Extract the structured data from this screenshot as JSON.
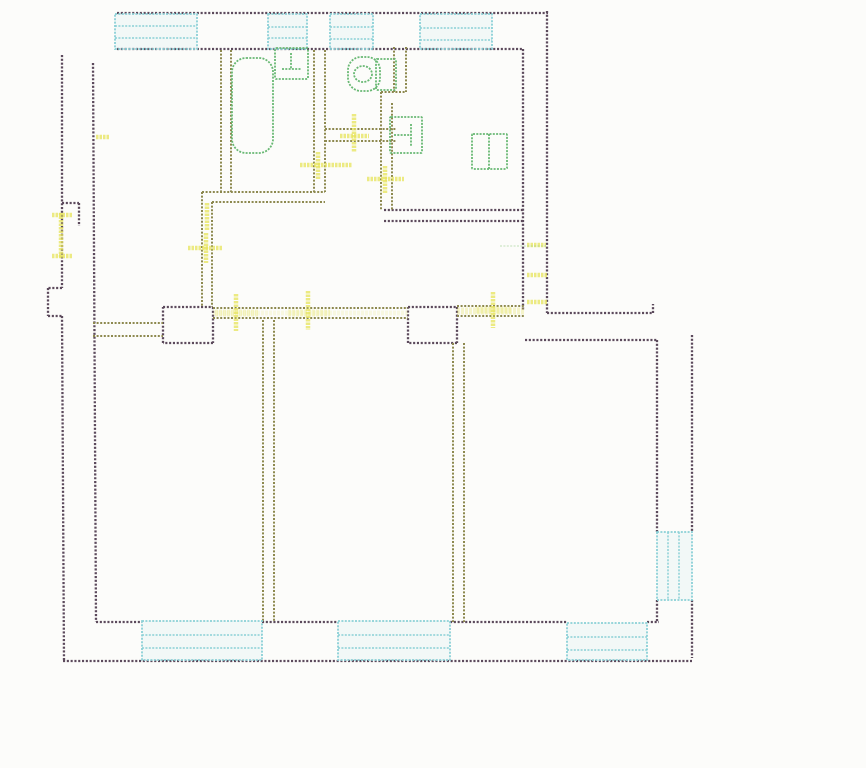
{
  "floor_plan": {
    "canvas": {
      "width": 866,
      "height": 768,
      "background": "#fcfcfa"
    },
    "colors": {
      "outer_wall": "#5c4a5c",
      "interior_wall": "#8d894f",
      "door_mark": "#e7e45b",
      "window_frame": "#8ad0d6",
      "window_fill": "rgba(185,227,232,0.14)",
      "fixture": "#68b873",
      "faint_green": "#9ccf8f"
    },
    "wall_layers": [
      {
        "name": "outer-wall",
        "color": "#5c4a5c",
        "width": 2.3,
        "dash": "2.1 1.7",
        "opacity": 1,
        "segments": [
          [
            117,
            13,
            548,
            13
          ],
          [
            117,
            49,
            523,
            49
          ],
          [
            523,
            49,
            523,
            310
          ],
          [
            547,
            11,
            547,
            313
          ],
          [
            547,
            313,
            653,
            313
          ],
          [
            653,
            313,
            653,
            304
          ],
          [
            525,
            340,
            657,
            340
          ],
          [
            657,
            340,
            657,
            532
          ],
          [
            657,
            600,
            657,
            622
          ],
          [
            692,
            335,
            692,
            532
          ],
          [
            692,
            600,
            692,
            658
          ],
          [
            63,
            661,
            692,
            661
          ],
          [
            96,
            622,
            142,
            622
          ],
          [
            262,
            622,
            338,
            622
          ],
          [
            450,
            622,
            567,
            622
          ],
          [
            647,
            622,
            659,
            622
          ],
          [
            62,
            55,
            62,
            288
          ],
          [
            62,
            288,
            48,
            288
          ],
          [
            48,
            288,
            48,
            316
          ],
          [
            48,
            316,
            62,
            316
          ],
          [
            62,
            316,
            64,
            661
          ],
          [
            93,
            63,
            96,
            622
          ],
          [
            62,
            203,
            79,
            203
          ],
          [
            79,
            203,
            79,
            226
          ],
          [
            163,
            307,
            213,
            307
          ],
          [
            213,
            307,
            213,
            343
          ],
          [
            213,
            343,
            163,
            343
          ],
          [
            163,
            343,
            163,
            307
          ],
          [
            408,
            307,
            457,
            307
          ],
          [
            457,
            307,
            457,
            343
          ],
          [
            457,
            343,
            408,
            343
          ],
          [
            408,
            343,
            408,
            307
          ],
          [
            384,
            210,
            523,
            210
          ],
          [
            384,
            221,
            523,
            221
          ]
        ]
      },
      {
        "name": "interior-wall",
        "color": "#8d894f",
        "width": 2.0,
        "dash": "2 1.6",
        "opacity": 1,
        "segments": [
          [
            221,
            50,
            221,
            192
          ],
          [
            231,
            50,
            231,
            192
          ],
          [
            202,
            192,
            325,
            192
          ],
          [
            212,
            202,
            325,
            202
          ],
          [
            202,
            192,
            202,
            307
          ],
          [
            212,
            202,
            212,
            307
          ],
          [
            314,
            50,
            314,
            192
          ],
          [
            325,
            50,
            325,
            192
          ],
          [
            325,
            129,
            397,
            129
          ],
          [
            325,
            141,
            397,
            141
          ],
          [
            394,
            47,
            394,
            92
          ],
          [
            406,
            47,
            406,
            92
          ],
          [
            381,
            92,
            406,
            92
          ],
          [
            381,
            92,
            381,
            210
          ],
          [
            392,
            103,
            392,
            210
          ],
          [
            93,
            323,
            163,
            323
          ],
          [
            93,
            336,
            163,
            336
          ],
          [
            213,
            308,
            408,
            308
          ],
          [
            213,
            318,
            408,
            318
          ],
          [
            457,
            306,
            524,
            306
          ],
          [
            457,
            316,
            524,
            316
          ],
          [
            263,
            320,
            263,
            622
          ],
          [
            274,
            320,
            274,
            622
          ],
          [
            453,
            343,
            453,
            622
          ],
          [
            464,
            343,
            464,
            622
          ]
        ]
      },
      {
        "name": "corridor-tint",
        "color": "#e7e45b",
        "width": 5,
        "dash": "3 1",
        "opacity": 0.15,
        "segments": [
          [
            213,
            313,
            408,
            313
          ]
        ]
      },
      {
        "name": "door-band",
        "color": "#e7e45b",
        "width": 7,
        "dash": "3 1",
        "opacity": 0.3,
        "segments": [
          [
            215,
            313,
            258,
            313
          ],
          [
            288,
            313,
            330,
            313
          ],
          [
            476,
            310,
            512,
            310
          ],
          [
            457,
            311,
            524,
            311
          ]
        ]
      },
      {
        "name": "door-mark",
        "color": "#e7e45b",
        "width": 4.5,
        "dash": "2.5 1",
        "opacity": 0.75,
        "segments": [
          [
            61,
            213,
            61,
            258
          ],
          [
            52,
            215,
            72,
            215
          ],
          [
            52,
            256,
            72,
            256
          ],
          [
            206,
            233,
            206,
            263
          ],
          [
            188,
            248,
            222,
            248
          ],
          [
            300,
            165,
            352,
            165
          ],
          [
            318,
            152,
            318,
            179
          ],
          [
            354,
            114,
            354,
            152
          ],
          [
            340,
            136,
            369,
            136
          ],
          [
            367,
            179,
            404,
            179
          ],
          [
            385,
            166,
            385,
            193
          ],
          [
            236,
            294,
            236,
            331
          ],
          [
            308,
            291,
            308,
            330
          ],
          [
            493,
            292,
            493,
            328
          ],
          [
            207,
            203,
            207,
            230
          ],
          [
            96,
            137,
            110,
            137
          ],
          [
            527,
            245,
            546,
            245
          ],
          [
            527,
            275,
            547,
            275
          ],
          [
            527,
            302,
            547,
            302
          ]
        ]
      },
      {
        "name": "faint-green-line",
        "color": "#9ccf8f",
        "width": 1.3,
        "dash": "2 1.4",
        "opacity": 0.5,
        "segments": [
          [
            500,
            246,
            546,
            246
          ]
        ]
      }
    ],
    "windows": [
      {
        "name": "window-top-1",
        "x": 115,
        "y": 14,
        "w": 82,
        "h": 35,
        "bars": [
          [
            115,
            26,
            197,
            26
          ],
          [
            115,
            38,
            197,
            38
          ]
        ]
      },
      {
        "name": "window-top-2",
        "x": 268,
        "y": 14,
        "w": 39,
        "h": 35,
        "bars": [
          [
            268,
            27,
            307,
            27
          ],
          [
            268,
            38,
            307,
            38
          ]
        ]
      },
      {
        "name": "window-top-3",
        "x": 330,
        "y": 14,
        "w": 43,
        "h": 35,
        "bars": [
          [
            330,
            27,
            373,
            27
          ],
          [
            330,
            39,
            373,
            39
          ]
        ]
      },
      {
        "name": "window-top-4",
        "x": 420,
        "y": 14,
        "w": 72,
        "h": 35,
        "bars": [
          [
            420,
            28,
            492,
            28
          ],
          [
            420,
            40,
            492,
            40
          ]
        ]
      },
      {
        "name": "window-bottom-1",
        "x": 142,
        "y": 621,
        "w": 120,
        "h": 39,
        "bars": [
          [
            142,
            635,
            262,
            635
          ],
          [
            142,
            648,
            262,
            648
          ]
        ]
      },
      {
        "name": "window-bottom-2",
        "x": 338,
        "y": 621,
        "w": 112,
        "h": 39,
        "bars": [
          [
            338,
            635,
            450,
            635
          ],
          [
            338,
            648,
            450,
            648
          ]
        ]
      },
      {
        "name": "window-bottom-3",
        "x": 567,
        "y": 623,
        "w": 80,
        "h": 37,
        "bars": [
          [
            567,
            637,
            647,
            637
          ],
          [
            567,
            650,
            647,
            650
          ]
        ]
      },
      {
        "name": "window-right",
        "x": 657,
        "y": 532,
        "w": 35,
        "h": 68,
        "bars": [
          [
            668,
            532,
            668,
            600
          ],
          [
            679,
            532,
            679,
            600
          ]
        ]
      }
    ],
    "fixtures": [
      {
        "name": "bathtub",
        "shape": "rect",
        "x": 232,
        "y": 58,
        "w": 41,
        "h": 95,
        "rx": 14
      },
      {
        "name": "washbasin",
        "shape": "rect",
        "x": 275,
        "y": 48,
        "w": 33,
        "h": 31,
        "rx": 1
      },
      {
        "name": "washbasin-tap",
        "shape": "line",
        "x1": 291,
        "y1": 53,
        "x2": 291,
        "y2": 69
      },
      {
        "name": "washbasin-tap",
        "shape": "line",
        "x1": 282,
        "y1": 69,
        "x2": 301,
        "y2": 69
      },
      {
        "name": "toilet-bowl",
        "shape": "rect",
        "x": 348,
        "y": 57,
        "w": 32,
        "h": 34,
        "rx": 13
      },
      {
        "name": "toilet-tank",
        "shape": "rect",
        "x": 376,
        "y": 59,
        "w": 20,
        "h": 31,
        "rx": 1
      },
      {
        "name": "toilet-seat",
        "shape": "ellipse",
        "cx": 363,
        "cy": 74,
        "rx": 9,
        "ry": 8
      },
      {
        "name": "kitchen-sink",
        "shape": "rect",
        "x": 390,
        "y": 117,
        "w": 32,
        "h": 36,
        "rx": 1
      },
      {
        "name": "kitchen-sink-tap",
        "shape": "line",
        "x1": 394,
        "y1": 135,
        "x2": 411,
        "y2": 135
      },
      {
        "name": "kitchen-sink-tap",
        "shape": "line",
        "x1": 411,
        "y1": 124,
        "x2": 411,
        "y2": 147
      },
      {
        "name": "stove",
        "shape": "rect",
        "x": 472,
        "y": 134,
        "w": 35,
        "h": 35,
        "rx": 1
      },
      {
        "name": "stove-divider",
        "shape": "line",
        "x1": 489,
        "y1": 134,
        "x2": 489,
        "y2": 169
      }
    ]
  }
}
